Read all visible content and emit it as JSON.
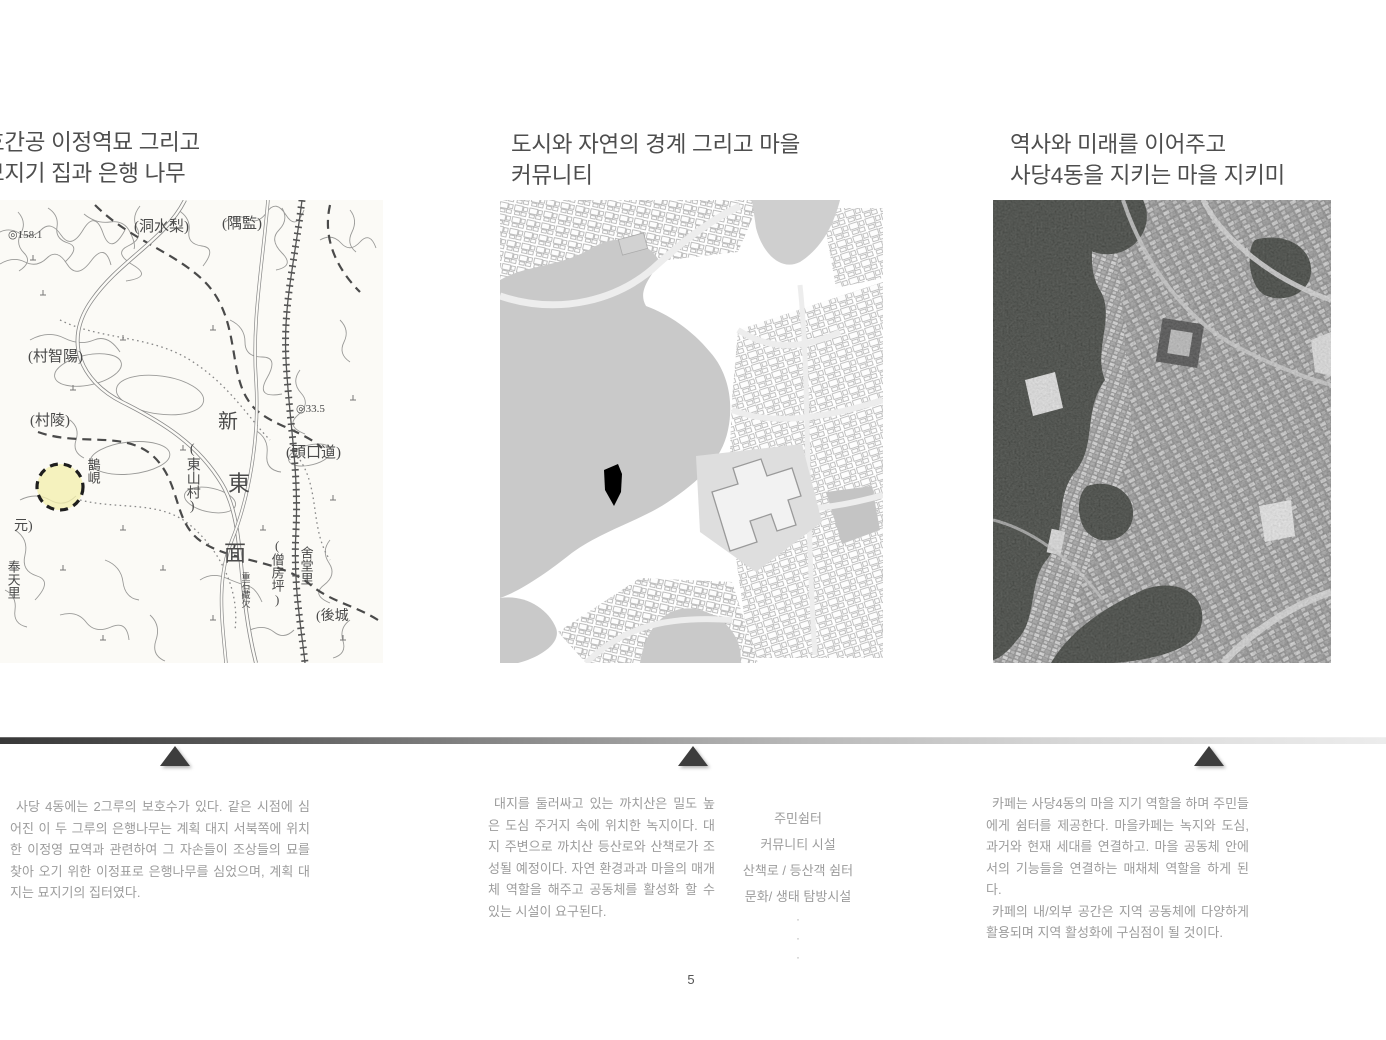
{
  "page": {
    "number": "5"
  },
  "colors": {
    "title_text": "#4e4e4e",
    "body_text": "#9c9c9c",
    "timeline_gradient_start": "#383838",
    "timeline_gradient_end": "#ececec",
    "marker_triangle": "#3d3d3d",
    "site_highlight_yellow": "#f4f0ae",
    "site_footprint_black": "#000000"
  },
  "panels": [
    {
      "title_lines": [
        "효간공 이정역묘 그리고",
        "묘지기 집과 은행 나무"
      ],
      "map_kind": "historic-topographic-map",
      "body_paragraphs": [
        "사당 4동에는 2그루의 보호수가 있다. 같은 시점에 심어진 이 두 그루의 은행나무는 계획 대지 서북쪽에 위치한 이정영 묘역과 관련하여 그 자손들이 조상들의 묘를 찾아 오기 위한 이정표로 은행나무를 심었으며, 계획 대지는 묘지기의 집터였다."
      ]
    },
    {
      "title_lines": [
        "도시와 자연의 경계 그리고 마을",
        "커뮤니티"
      ],
      "map_kind": "figure-ground-map",
      "body_paragraphs": [
        "대지를 둘러싸고 있는 까치산은 밀도 높은 도심 주거지 속에 위치한 녹지이다. 대지 주변으로 까치산 등산로와 산책로가 조성될 예정이다. 자연 환경과과 마을의 매개체 역할을 해주고 공동체를 활성화 할 수 있는 시설이 요구된다."
      ]
    },
    {
      "title_lines": [
        "역사와 미래를 이어주고",
        "사당4동을 지키는 마을 지키미"
      ],
      "map_kind": "aerial-photo-map",
      "body_paragraphs": [
        "카페는 사당4동의 마을 지기 역할을 하며 주민들에게 쉼터를 제공한다. 마을카페는 녹지와 도심, 과거와 현재 세대를 연결하고. 마을 공동체 안에서의 기능들을 연결하는 매채체 역할을 하게 된다.",
        "카페의 내/외부 공간은 지역 공동체에 다양하게 활용되며 지역 활성화에 구심점이 될 것이다."
      ]
    }
  ],
  "facility_list": {
    "items": [
      "주민쉼터",
      "커뮤니티 시설",
      "산책로 / 등산객 쉼터",
      "문화/ 생태 탐방시설",
      "·",
      "·",
      "·"
    ]
  },
  "old_map_labels": [
    {
      "text": "◎158.1"
    },
    {
      "text": "(洞水梨)"
    },
    {
      "text": "(隅監)"
    },
    {
      "text": "(村智陽)"
    },
    {
      "text": "(村陵)"
    },
    {
      "text": "◎33.5"
    },
    {
      "text": "新"
    },
    {
      "text": "(頭口道)"
    },
    {
      "text": "(東山村)"
    },
    {
      "text": "東"
    },
    {
      "text": "面"
    },
    {
      "text": "鵲峴"
    },
    {
      "text": "元)"
    },
    {
      "text": "奉天里"
    },
    {
      "text": "(僧房坪)"
    },
    {
      "text": "舍堂里"
    },
    {
      "text": "(後城"
    },
    {
      "text": "重石藏欠"
    }
  ]
}
